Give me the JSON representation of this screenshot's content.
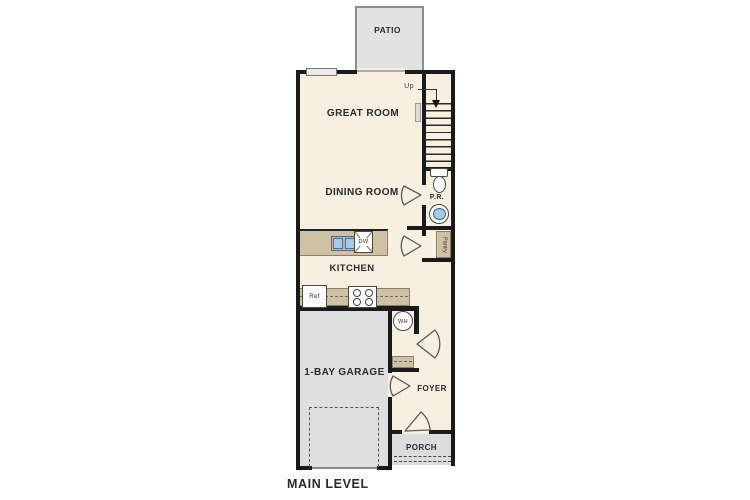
{
  "plan": {
    "title": "MAIN LEVEL",
    "labels": {
      "patio": "PATIO",
      "great_room": "GREAT ROOM",
      "dining_room": "DINING ROOM",
      "kitchen": "KITCHEN",
      "garage": "1-BAY GARAGE",
      "foyer": "FOYER",
      "porch": "PORCH",
      "powder_room": "P.R.",
      "pantry": "Pantry",
      "stairs_up": "Up",
      "water_heater": "WH",
      "dishwasher": "DW",
      "refrigerator": "Ref"
    },
    "colors": {
      "floor": "#f7efdf",
      "concrete": "#e2e2e2",
      "tan": "#cfc1a4",
      "wall": "#1a1a1a",
      "blue": "#a9cae6",
      "text": "#2b2b2b"
    }
  }
}
